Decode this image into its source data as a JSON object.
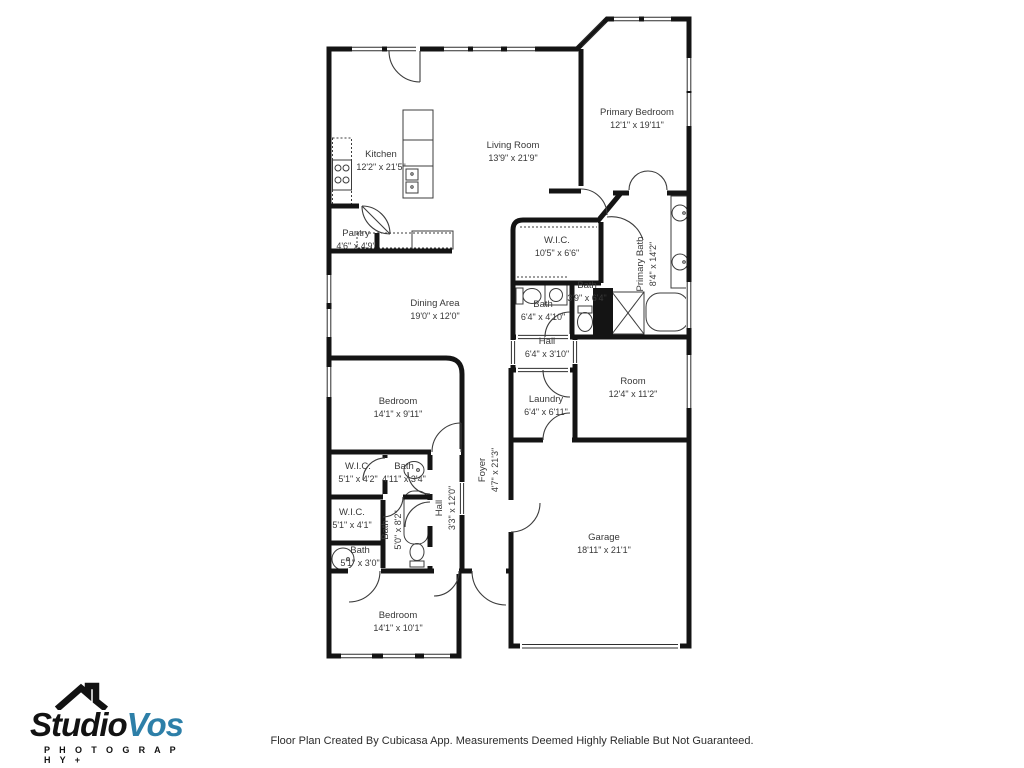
{
  "branding": {
    "studio": "Studio",
    "vos": "Vos",
    "tagline": "P H O T O G R A P H Y +",
    "brand_blue": "#2d7fa8",
    "brand_black": "#121212",
    "icon": "house-roof-icon"
  },
  "footer": {
    "disclaimer": "Floor Plan Created By Cubicasa App. Measurements Deemed Highly Reliable But Not Guaranteed."
  },
  "floor_plan": {
    "wall_color": "#141414",
    "fixture_color": "#3c3c3c",
    "label_color": "#383838",
    "rooms": [
      {
        "name": "Kitchen",
        "dims": "12'2\" x 21'5\"",
        "x": 381,
        "y": 161,
        "rot": 0
      },
      {
        "name": "Living Room",
        "dims": "13'9\" x 21'9\"",
        "x": 513,
        "y": 152,
        "rot": 0
      },
      {
        "name": "Primary Bedroom",
        "dims": "12'1\" x 19'11\"",
        "x": 637,
        "y": 119,
        "rot": 0
      },
      {
        "name": "Pantry",
        "dims": "4'6\" x 4'9\"",
        "x": 356,
        "y": 240,
        "rot": 0
      },
      {
        "name": "W.I.C.",
        "dims": "10'5\" x 6'6\"",
        "x": 557,
        "y": 247,
        "rot": 0
      },
      {
        "name": "Primary Bath",
        "dims": "8'4\" x 14'2\"",
        "x": 647,
        "y": 264,
        "rot": -90
      },
      {
        "name": "Bath",
        "dims": "6'4\" x 4'10\"",
        "x": 543,
        "y": 311,
        "rot": 0
      },
      {
        "name": "Bath",
        "dims": "3'9\" x 6'4\"",
        "x": 587,
        "y": 292,
        "rot": 0
      },
      {
        "name": "Hall",
        "dims": "6'4\" x 3'10\"",
        "x": 547,
        "y": 348,
        "rot": 0
      },
      {
        "name": "Dining Area",
        "dims": "19'0\" x 12'0\"",
        "x": 435,
        "y": 310,
        "rot": 0
      },
      {
        "name": "Room",
        "dims": "12'4\" x 11'2\"",
        "x": 633,
        "y": 388,
        "rot": 0
      },
      {
        "name": "Laundry",
        "dims": "6'4\" x 6'11\"",
        "x": 546,
        "y": 406,
        "rot": 0
      },
      {
        "name": "Bedroom",
        "dims": "14'1\" x 9'11\"",
        "x": 398,
        "y": 408,
        "rot": 0
      },
      {
        "name": "W.I.C.",
        "dims": "5'1\" x 4'2\"",
        "x": 358,
        "y": 473,
        "rot": 0
      },
      {
        "name": "Bath",
        "dims": "4'11\" x 3'4\"",
        "x": 404,
        "y": 473,
        "rot": 0
      },
      {
        "name": "W.I.C.",
        "dims": "5'1\" x 4'1\"",
        "x": 352,
        "y": 519,
        "rot": 0
      },
      {
        "name": "Bath",
        "dims": "5'0\" x 8'2\"",
        "x": 392,
        "y": 530,
        "rot": -90
      },
      {
        "name": "Hall",
        "dims": "3'3\" x 12'0\"",
        "x": 446,
        "y": 508,
        "rot": -90
      },
      {
        "name": "Foyer",
        "dims": "4'7\" x 21'3\"",
        "x": 489,
        "y": 470,
        "rot": -90
      },
      {
        "name": "Bath",
        "dims": "5'1\" x 3'0\"",
        "x": 360,
        "y": 557,
        "rot": 0
      },
      {
        "name": "Garage",
        "dims": "18'11\" x 21'1\"",
        "x": 604,
        "y": 544,
        "rot": 0
      },
      {
        "name": "Bedroom",
        "dims": "14'1\" x 10'1\"",
        "x": 398,
        "y": 622,
        "rot": 0
      }
    ]
  }
}
